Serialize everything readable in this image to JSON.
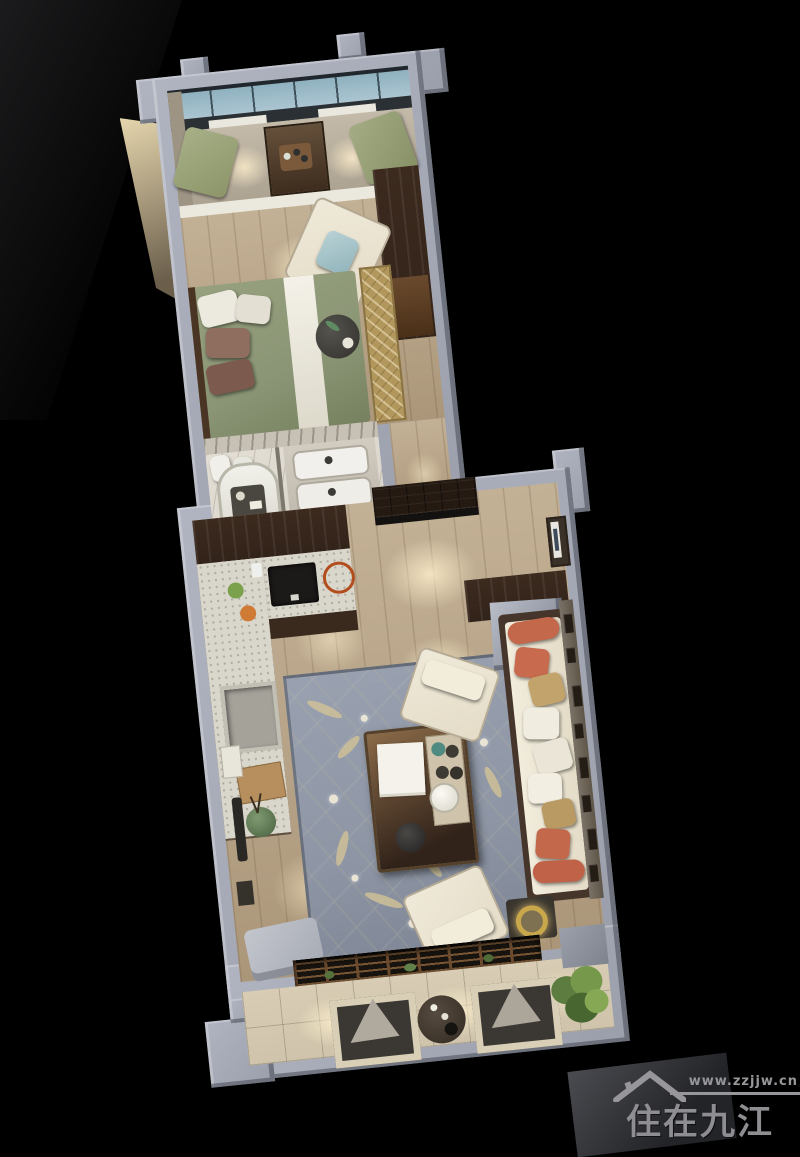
{
  "meta": {
    "description": "Top-down 3D dollhouse render of a one-bedroom apartment at night on a black background, new-Chinese interior style, unit tilted slightly counter-clockwise"
  },
  "watermark": {
    "url": "www.zzjjw.cn",
    "brand": "住在九江",
    "icon": "house-roof-icon",
    "color": "#97979b"
  },
  "rooms": [
    {
      "id": "bay-window-seat",
      "label": "Bay window tatami seat with green cushions and tea cabinet"
    },
    {
      "id": "bedroom",
      "label": "Bedroom with green bed, armchair and dark wardrobe"
    },
    {
      "id": "bathroom",
      "label": "Bathroom with tub, double vanity and marble walls"
    },
    {
      "id": "hallway",
      "label": "Wood hallway linking bedroom zone to living zone"
    },
    {
      "id": "kitchen",
      "label": "L-shaped kitchen counter with cooktop and sink"
    },
    {
      "id": "entry",
      "label": "Entry with dark double door and wall picture"
    },
    {
      "id": "living-room",
      "label": "Living room with cream sofa, coral pillows, tea table and blue floral rug"
    },
    {
      "id": "balcony",
      "label": "Balcony with lounge chairs, round table, plant and lattice screen"
    }
  ],
  "palette": {
    "bg": "#000000",
    "wall": "#b0b4c0",
    "wall_face": "#9b9fab",
    "wood": "#c3b196",
    "tile": "#cfc4ab",
    "marble": "#d8d3ca",
    "counter": "#d9d6cb",
    "cabinet": "#32231a",
    "rug_blue": "#8e96a5",
    "rug_gold": "#b2975c",
    "bed_green": "#8a9575",
    "sofa_cream": "#e4dcc7",
    "pillow_coral": "#c4684c",
    "pillow_gold": "#c2a36b",
    "window_blue": "#b6cdd8",
    "lattice": "#17130e",
    "lattice_wood": "#6b4a2e",
    "plant": "#5d7c3f",
    "lamp": "#c9a84c",
    "watermark": "#97979b"
  }
}
